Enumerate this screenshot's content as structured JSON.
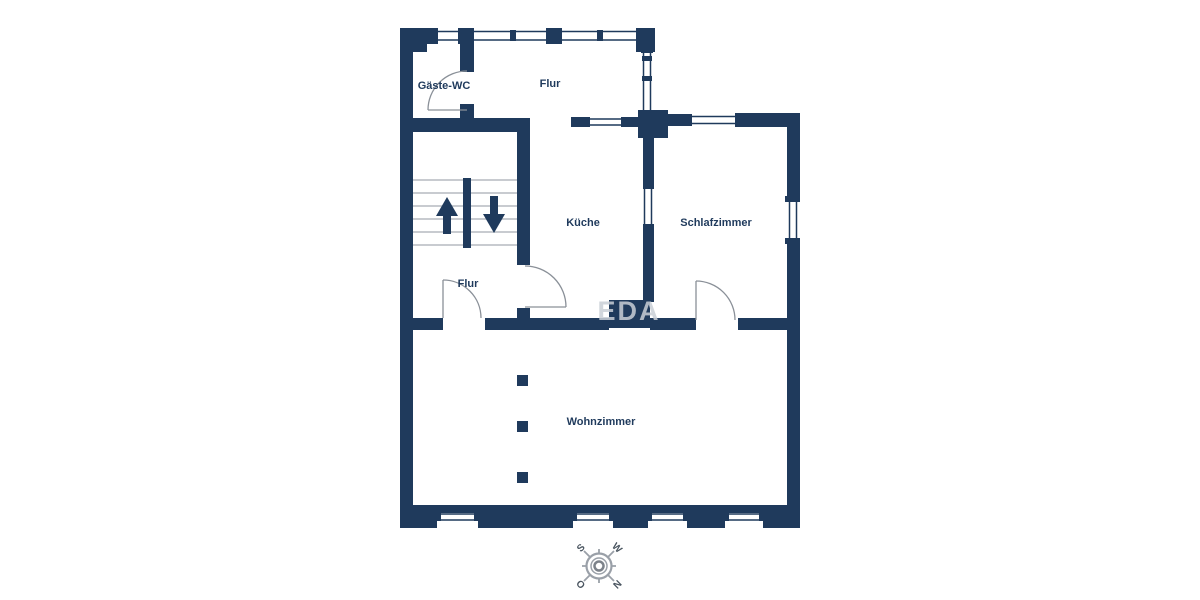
{
  "plan": {
    "rooms": [
      {
        "id": "gaeste-wc",
        "label": "Gäste-WC"
      },
      {
        "id": "flur-top",
        "label": "Flur"
      },
      {
        "id": "kueche",
        "label": "Küche"
      },
      {
        "id": "schlafzimmer",
        "label": "Schlafzimmer"
      },
      {
        "id": "flur-lower",
        "label": "Flur"
      },
      {
        "id": "wohnzimmer",
        "label": "Wohnzimmer"
      }
    ],
    "watermark": "EDA",
    "compass": {
      "s": "S",
      "w": "W",
      "n": "N",
      "o": "O"
    },
    "colors": {
      "wall": "#1f3a5c",
      "door_line": "#8a9098",
      "stair_tread": "#b6bac1",
      "watermark": "#c9cfd7",
      "compass": "#9aa0a8"
    }
  }
}
